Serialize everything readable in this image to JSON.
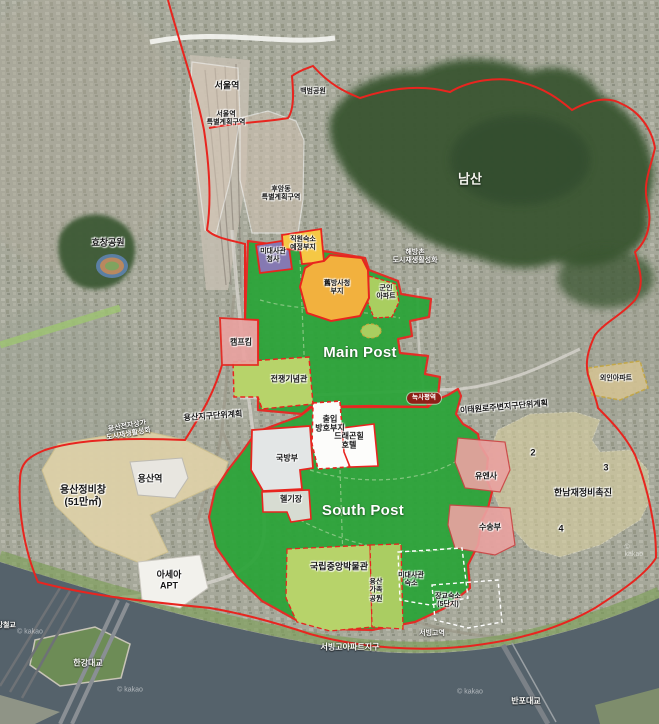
{
  "attribution": "© kakao",
  "colors": {
    "post_green": "#2aa438",
    "park_light_green": "#b7d36a",
    "site_orange": "#f2b13e",
    "site_yellow": "#f5c845",
    "embassy_purple": "#8579b2",
    "returned_site_pink": "#e9a2a0",
    "district_beige": "#ded1a8",
    "boundary_red": "#e8251f",
    "river": "#55626b",
    "forest_green": "#3a5733",
    "station_badge_red": "#8e1f17"
  },
  "labels": {
    "seoul_station": "서울역",
    "seoul_station_district": "서울역\n특별계획구역",
    "huam_district": "후암동\n특별계획구역",
    "baekbeom_park": "백범공원",
    "namsan": "남산",
    "haebangchon": "해방촌\n도시재생활성화",
    "hyochang_park": "효창공원",
    "us_embassy_office": "미대사관\n청사",
    "staff_housing_site": "직원숙소\n예정부지",
    "dapa_site": "舊방사청\n부지",
    "military_apartment": "군인\n아파트",
    "camp_kim": "캠프킴",
    "main_post": "Main Post",
    "war_memorial": "전쟁기념관",
    "yongsan_district_plan": "용산지구단위계획",
    "yongsan_electronics": "용산전자상가\n도시재생활성화",
    "noksapyeong_station": "녹사평역",
    "itaewon_district_plan": "이태원로주변지구단위계획",
    "access_protection_site": "출입\n방호부지",
    "dragon_hill_hotel": "드래곤힐\n호텔",
    "ministry_of_defense": "국방부",
    "heliport": "헬기장",
    "south_post": "South Post",
    "yongsan_railyard": "용산정비창\n(51만㎡)",
    "yongsan_station": "용산역",
    "foreigner_apartment": "외인아파트",
    "unc_site": "유엔사",
    "hannam_redevelopment": "한남재정비촉진",
    "hannam_district_2": "2",
    "hannam_district_3": "3",
    "hannam_district_4": "4",
    "transport_unit_site": "수송부",
    "asea_apartment": "아세아\nAPT",
    "national_museum": "국립중앙박물관",
    "family_park": "용산\n가족\n공원",
    "embassy_housing": "미대사관\n숙소",
    "officer_housing": "장교숙소\n(5단지)",
    "seobinggo_apartment": "서빙고아파트지구",
    "seobinggo_station": "서빙고역",
    "hangang_rail_bridge": "한강철교",
    "hangang_bridge": "한강대교",
    "banpo_bridge": "반포대교"
  }
}
